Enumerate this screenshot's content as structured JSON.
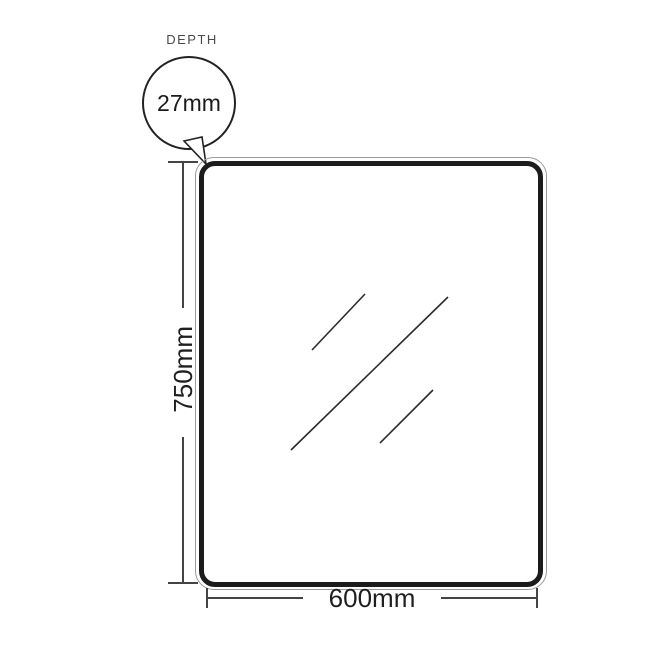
{
  "diagram": {
    "type": "product-dimension-drawing",
    "subject": "rectangular mirror with rounded corners"
  },
  "depth_callout": {
    "label": "DEPTH",
    "value": "27mm"
  },
  "height_dimension": {
    "value": "750mm"
  },
  "width_dimension": {
    "value": "600mm"
  },
  "colors": {
    "background": "#ffffff",
    "mirror_border": "#1c1c1c",
    "mirror_edge_line": "#9b9b9b",
    "dimension_line": "#444444",
    "depth_label_text": "#4a4a4a",
    "dimension_text": "#1f1f1f",
    "reflection_line": "#2b2b2b",
    "callout_stroke": "#222222"
  }
}
